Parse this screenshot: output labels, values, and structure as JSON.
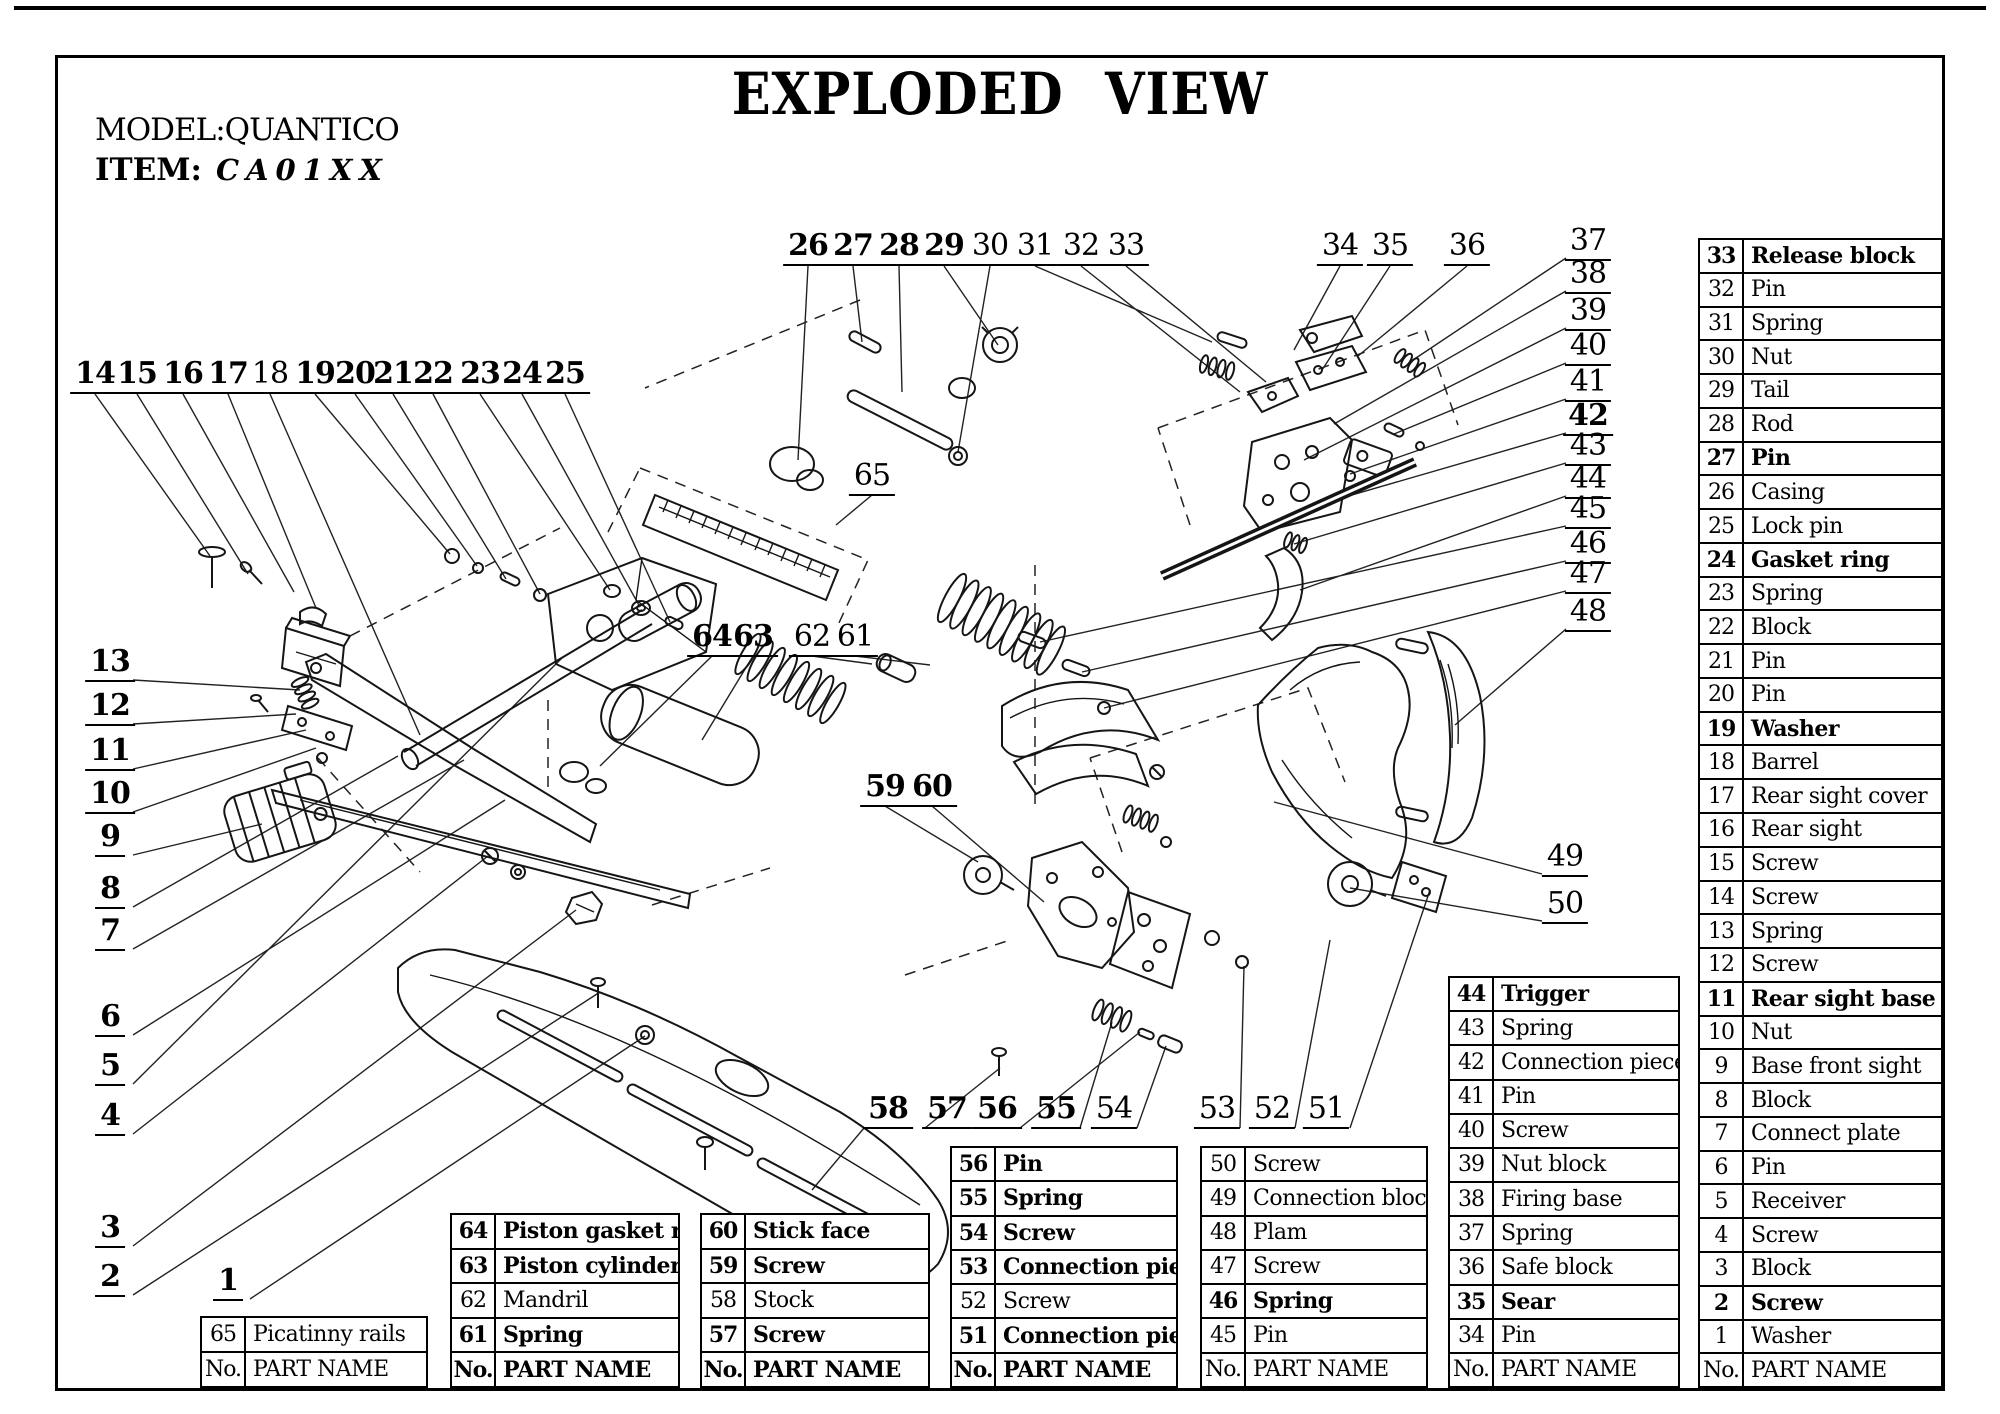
{
  "page": {
    "title": "EXPLODED VIEW",
    "model_label": "MODEL:QUANTICO",
    "item_label": "ITEM:",
    "item_value": "CA01XX"
  },
  "tables": {
    "main": {
      "footer": {
        "no": "No.",
        "name": "PART NAME"
      },
      "footer_bold": false,
      "rows": [
        {
          "no": "33",
          "name": "Release block",
          "bold": true
        },
        {
          "no": "32",
          "name": "Pin",
          "bold": false
        },
        {
          "no": "31",
          "name": "Spring",
          "bold": false
        },
        {
          "no": "30",
          "name": "Nut",
          "bold": false
        },
        {
          "no": "29",
          "name": "Tail",
          "bold": false
        },
        {
          "no": "28",
          "name": "Rod",
          "bold": false
        },
        {
          "no": "27",
          "name": "Pin",
          "bold": true
        },
        {
          "no": "26",
          "name": "Casing",
          "bold": false
        },
        {
          "no": "25",
          "name": "Lock pin",
          "bold": false
        },
        {
          "no": "24",
          "name": "Gasket ring",
          "bold": true
        },
        {
          "no": "23",
          "name": "Spring",
          "bold": false
        },
        {
          "no": "22",
          "name": "Block",
          "bold": false
        },
        {
          "no": "21",
          "name": "Pin",
          "bold": false
        },
        {
          "no": "20",
          "name": "Pin",
          "bold": false
        },
        {
          "no": "19",
          "name": "Washer",
          "bold": true
        },
        {
          "no": "18",
          "name": "Barrel",
          "bold": false
        },
        {
          "no": "17",
          "name": "Rear sight cover",
          "bold": false
        },
        {
          "no": "16",
          "name": "Rear sight",
          "bold": false
        },
        {
          "no": "15",
          "name": "Screw",
          "bold": false
        },
        {
          "no": "14",
          "name": "Screw",
          "bold": false
        },
        {
          "no": "13",
          "name": "Spring",
          "bold": false
        },
        {
          "no": "12",
          "name": "Screw",
          "bold": false
        },
        {
          "no": "11",
          "name": "Rear sight base",
          "bold": true
        },
        {
          "no": "10",
          "name": "Nut",
          "bold": false
        },
        {
          "no": "9",
          "name": "Base front sight",
          "bold": false
        },
        {
          "no": "8",
          "name": "Block",
          "bold": false
        },
        {
          "no": "7",
          "name": "Connect plate",
          "bold": false
        },
        {
          "no": "6",
          "name": "Pin",
          "bold": false
        },
        {
          "no": "5",
          "name": "Receiver",
          "bold": false
        },
        {
          "no": "4",
          "name": "Screw",
          "bold": false
        },
        {
          "no": "3",
          "name": "Block",
          "bold": false
        },
        {
          "no": "2",
          "name": "Screw",
          "bold": true
        },
        {
          "no": "1",
          "name": "Washer",
          "bold": false
        }
      ]
    },
    "t44": {
      "footer": {
        "no": "No.",
        "name": "PART NAME"
      },
      "footer_bold": false,
      "rows": [
        {
          "no": "44",
          "name": "Trigger",
          "bold": true
        },
        {
          "no": "43",
          "name": "Spring",
          "bold": false
        },
        {
          "no": "42",
          "name": "Connection piece",
          "bold": false
        },
        {
          "no": "41",
          "name": "Pin",
          "bold": false
        },
        {
          "no": "40",
          "name": "Screw",
          "bold": false
        },
        {
          "no": "39",
          "name": "Nut block",
          "bold": false
        },
        {
          "no": "38",
          "name": "Firing base",
          "bold": false
        },
        {
          "no": "37",
          "name": "Spring",
          "bold": false
        },
        {
          "no": "36",
          "name": "Safe block",
          "bold": false
        },
        {
          "no": "35",
          "name": "Sear",
          "bold": true
        },
        {
          "no": "34",
          "name": "Pin",
          "bold": false
        }
      ]
    },
    "t50": {
      "footer": {
        "no": "No.",
        "name": "PART NAME"
      },
      "footer_bold": false,
      "rows": [
        {
          "no": "50",
          "name": "Screw",
          "bold": false
        },
        {
          "no": "49",
          "name": "Connection block",
          "bold": false
        },
        {
          "no": "48",
          "name": "Plam",
          "bold": false
        },
        {
          "no": "47",
          "name": "Screw",
          "bold": false
        },
        {
          "no": "46",
          "name": "Spring",
          "bold": true
        },
        {
          "no": "45",
          "name": "Pin",
          "bold": false
        }
      ]
    },
    "t56": {
      "footer": {
        "no": "No.",
        "name": "PART NAME"
      },
      "footer_bold": true,
      "rows": [
        {
          "no": "56",
          "name": "Pin",
          "bold": true
        },
        {
          "no": "55",
          "name": "Spring",
          "bold": true
        },
        {
          "no": "54",
          "name": "Screw",
          "bold": true
        },
        {
          "no": "53",
          "name": "Connection piece",
          "bold": true
        },
        {
          "no": "52",
          "name": "Screw",
          "bold": false
        },
        {
          "no": "51",
          "name": "Connection piece",
          "bold": true
        }
      ]
    },
    "t60": {
      "footer": {
        "no": "No.",
        "name": "PART NAME"
      },
      "footer_bold": true,
      "rows": [
        {
          "no": "60",
          "name": "Stick face",
          "bold": true
        },
        {
          "no": "59",
          "name": "Screw",
          "bold": true
        },
        {
          "no": "58",
          "name": "Stock",
          "bold": false
        },
        {
          "no": "57",
          "name": "Screw",
          "bold": true
        }
      ]
    },
    "t64": {
      "footer": {
        "no": "No.",
        "name": "PART NAME"
      },
      "footer_bold": true,
      "rows": [
        {
          "no": "64",
          "name": "Piston gasket ring",
          "bold": true
        },
        {
          "no": "63",
          "name": "Piston cylinder",
          "bold": true
        },
        {
          "no": "62",
          "name": "Mandril",
          "bold": false
        },
        {
          "no": "61",
          "name": "Spring",
          "bold": true
        }
      ]
    },
    "t65": {
      "footer": {
        "no": "No.",
        "name": "PART NAME"
      },
      "footer_bold": false,
      "rows": [
        {
          "no": "65",
          "name": "Picatinny rails",
          "bold": false
        }
      ]
    }
  },
  "callouts": [
    {
      "n": "1",
      "x": 228,
      "y": 1282,
      "bold": true
    },
    {
      "n": "2",
      "x": 110,
      "y": 1278,
      "bold": true
    },
    {
      "n": "3",
      "x": 110,
      "y": 1229,
      "bold": true
    },
    {
      "n": "4",
      "x": 110,
      "y": 1117,
      "bold": true
    },
    {
      "n": "5",
      "x": 110,
      "y": 1067,
      "bold": true
    },
    {
      "n": "6",
      "x": 110,
      "y": 1018,
      "bold": true
    },
    {
      "n": "7",
      "x": 110,
      "y": 932,
      "bold": true
    },
    {
      "n": "8",
      "x": 110,
      "y": 890,
      "bold": true
    },
    {
      "n": "9",
      "x": 110,
      "y": 838,
      "bold": true
    },
    {
      "n": "10",
      "x": 110,
      "y": 795,
      "bold": true
    },
    {
      "n": "11",
      "x": 110,
      "y": 752,
      "bold": true
    },
    {
      "n": "12",
      "x": 110,
      "y": 707,
      "bold": true
    },
    {
      "n": "13",
      "x": 110,
      "y": 663,
      "bold": true
    },
    {
      "n": "14",
      "x": 95,
      "y": 375,
      "bold": true
    },
    {
      "n": "15",
      "x": 137,
      "y": 375,
      "bold": true
    },
    {
      "n": "16",
      "x": 183,
      "y": 375,
      "bold": true
    },
    {
      "n": "17",
      "x": 228,
      "y": 375,
      "bold": true
    },
    {
      "n": "18",
      "x": 270,
      "y": 375,
      "bold": false
    },
    {
      "n": "19",
      "x": 315,
      "y": 375,
      "bold": true
    },
    {
      "n": "20",
      "x": 355,
      "y": 375,
      "bold": true
    },
    {
      "n": "21",
      "x": 393,
      "y": 375,
      "bold": true
    },
    {
      "n": "22",
      "x": 433,
      "y": 375,
      "bold": true
    },
    {
      "n": "23",
      "x": 480,
      "y": 375,
      "bold": true
    },
    {
      "n": "24",
      "x": 522,
      "y": 375,
      "bold": true
    },
    {
      "n": "25",
      "x": 565,
      "y": 375,
      "bold": true
    },
    {
      "n": "26",
      "x": 808,
      "y": 247,
      "bold": true
    },
    {
      "n": "27",
      "x": 853,
      "y": 247,
      "bold": true
    },
    {
      "n": "28",
      "x": 899,
      "y": 247,
      "bold": true
    },
    {
      "n": "29",
      "x": 944,
      "y": 247,
      "bold": true
    },
    {
      "n": "30",
      "x": 990,
      "y": 247,
      "bold": false
    },
    {
      "n": "31",
      "x": 1035,
      "y": 247,
      "bold": false
    },
    {
      "n": "32",
      "x": 1081,
      "y": 247,
      "bold": false
    },
    {
      "n": "33",
      "x": 1126,
      "y": 247,
      "bold": false
    },
    {
      "n": "34",
      "x": 1340,
      "y": 247,
      "bold": false
    },
    {
      "n": "35",
      "x": 1390,
      "y": 247,
      "bold": false
    },
    {
      "n": "36",
      "x": 1467,
      "y": 247,
      "bold": false
    },
    {
      "n": "37",
      "x": 1588,
      "y": 242,
      "bold": false
    },
    {
      "n": "38",
      "x": 1588,
      "y": 275,
      "bold": false
    },
    {
      "n": "39",
      "x": 1588,
      "y": 312,
      "bold": false
    },
    {
      "n": "40",
      "x": 1588,
      "y": 347,
      "bold": false
    },
    {
      "n": "41",
      "x": 1588,
      "y": 383,
      "bold": false
    },
    {
      "n": "42",
      "x": 1588,
      "y": 417,
      "bold": true
    },
    {
      "n": "43",
      "x": 1588,
      "y": 447,
      "bold": false
    },
    {
      "n": "44",
      "x": 1588,
      "y": 480,
      "bold": false
    },
    {
      "n": "45",
      "x": 1588,
      "y": 510,
      "bold": false
    },
    {
      "n": "46",
      "x": 1588,
      "y": 545,
      "bold": false
    },
    {
      "n": "47",
      "x": 1588,
      "y": 575,
      "bold": false
    },
    {
      "n": "48",
      "x": 1588,
      "y": 613,
      "bold": false
    },
    {
      "n": "49",
      "x": 1565,
      "y": 858,
      "bold": false
    },
    {
      "n": "50",
      "x": 1565,
      "y": 905,
      "bold": false
    },
    {
      "n": "51",
      "x": 1326,
      "y": 1110,
      "bold": false
    },
    {
      "n": "52",
      "x": 1272,
      "y": 1110,
      "bold": false
    },
    {
      "n": "53",
      "x": 1217,
      "y": 1110,
      "bold": false
    },
    {
      "n": "54",
      "x": 1114,
      "y": 1110,
      "bold": false
    },
    {
      "n": "55",
      "x": 1056,
      "y": 1110,
      "bold": true
    },
    {
      "n": "56",
      "x": 997,
      "y": 1110,
      "bold": true
    },
    {
      "n": "57",
      "x": 947,
      "y": 1110,
      "bold": true
    },
    {
      "n": "58",
      "x": 888,
      "y": 1110,
      "bold": true
    },
    {
      "n": "59",
      "x": 885,
      "y": 788,
      "bold": true
    },
    {
      "n": "60",
      "x": 932,
      "y": 788,
      "bold": true
    },
    {
      "n": "61",
      "x": 855,
      "y": 638,
      "bold": false
    },
    {
      "n": "62",
      "x": 812,
      "y": 638,
      "bold": false
    },
    {
      "n": "63",
      "x": 753,
      "y": 638,
      "bold": true
    },
    {
      "n": "64",
      "x": 712,
      "y": 638,
      "bold": true
    },
    {
      "n": "65",
      "x": 872,
      "y": 477,
      "bold": false
    }
  ]
}
